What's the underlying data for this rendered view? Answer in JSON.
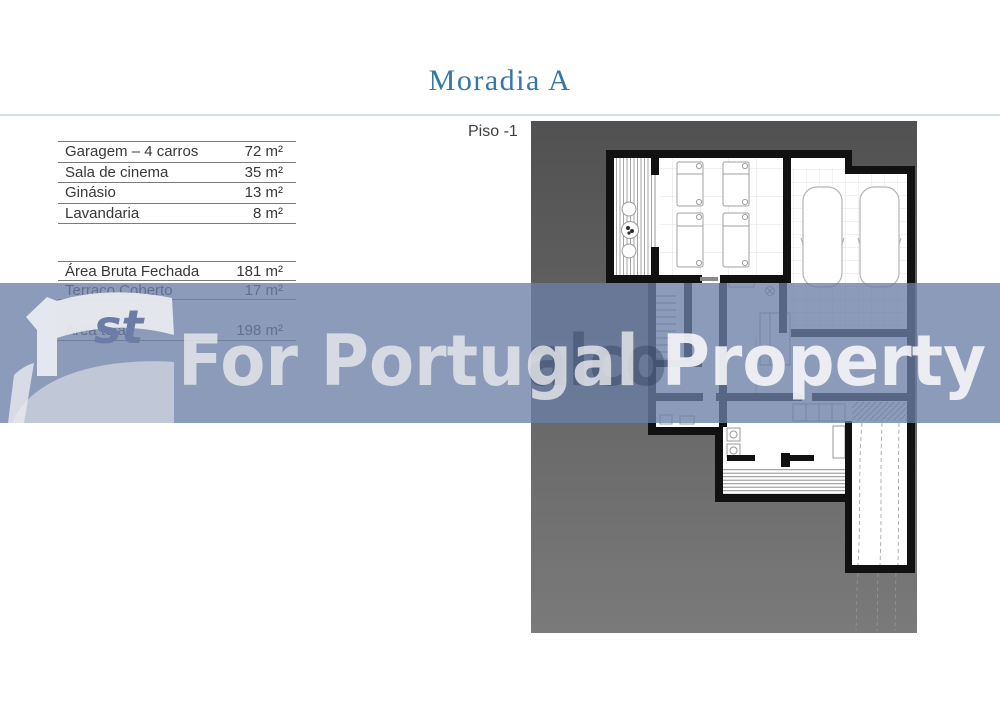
{
  "header": {
    "title": "Moradia A",
    "title_color": "#3577a7",
    "floor_label": "Piso -1"
  },
  "room_table": {
    "rows": [
      {
        "label": "Garagem – 4 carros",
        "value": "72 m²"
      },
      {
        "label": "Sala de cinema",
        "value": "35 m²"
      },
      {
        "label": "Ginásio",
        "value": "13 m²"
      },
      {
        "label": "Lavandaria",
        "value": "8 m²"
      }
    ]
  },
  "totals_table": {
    "rows": [
      {
        "label": "Área Bruta Fechada",
        "value": "181 m²"
      },
      {
        "label": "Terraço Coberto",
        "value": "17 m²"
      },
      {
        "label": "Área total",
        "value": "198 m²"
      }
    ]
  },
  "watermark": {
    "text_primary": "For Portugal ",
    "text_secondary": "Property",
    "ghost_text": "alco",
    "logo_suffix": "st",
    "band_color": "rgba(109,127,167,0.78)"
  },
  "floorplan": {
    "site_color_top": "#515151",
    "site_color_bottom": "#7a7a7a",
    "wall_color": "#111111",
    "garage_cars": 2,
    "cinema_seats": 4
  }
}
